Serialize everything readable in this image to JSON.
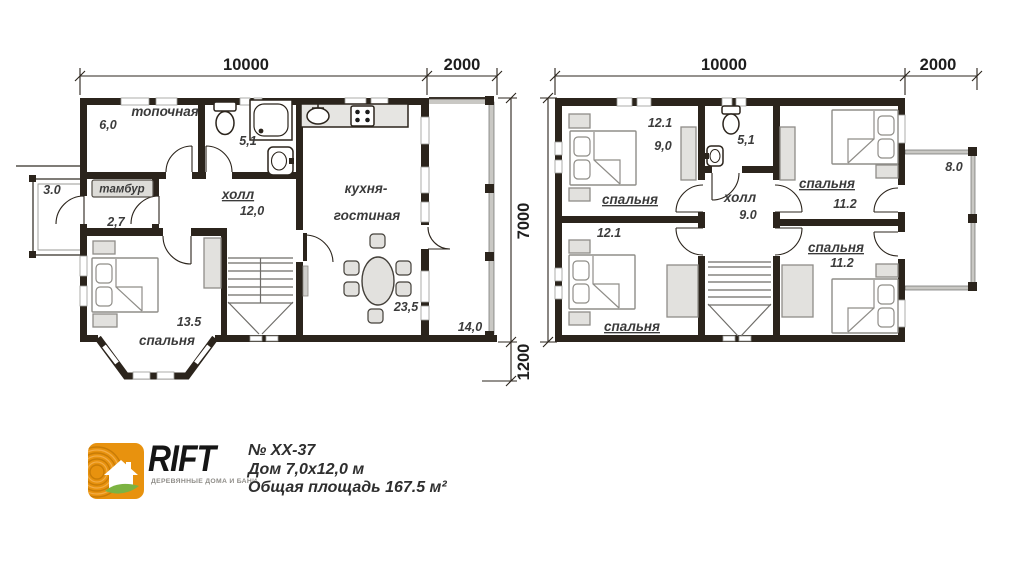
{
  "colors": {
    "wall": "#2b241c",
    "furniture": "#e2e1de",
    "logo_orange": "#e8920e",
    "logo_green": "#7cb342",
    "text": "#3b3b3b"
  },
  "floor1": {
    "dims": {
      "top_main": "10000",
      "top_terrace": "2000",
      "right_total": "7000",
      "right_bay": "1200"
    },
    "rooms": {
      "boiler": {
        "name": "топочная",
        "area": "6,0"
      },
      "porch": {
        "area": "3.0"
      },
      "vestibule": {
        "name": "тамбур",
        "area": "2,7"
      },
      "bathroom": {
        "area": "5,1"
      },
      "hall": {
        "name": "холл",
        "area": "12,0"
      },
      "kitchen_living": {
        "name_line1": "кухня-",
        "name_line2": "гостиная",
        "area": "23,5"
      },
      "bedroom": {
        "name": "спальня",
        "area": "13.5"
      },
      "terrace": {
        "area": "14,0"
      }
    }
  },
  "floor2": {
    "dims": {
      "top_main": "10000",
      "top_balcony": "2000"
    },
    "rooms": {
      "bedroom_top_left": {
        "name": "спальня",
        "area": "12.1",
        "area_extra": "9,0"
      },
      "bathroom": {
        "area": "5,1"
      },
      "bedroom_top_right": {
        "name": "спальня",
        "area": "11.2"
      },
      "hall": {
        "name": "холл",
        "area": "9.0"
      },
      "bedroom_bottom_left": {
        "name": "спальня",
        "area": "12.1"
      },
      "bedroom_bottom_right": {
        "name": "спальня",
        "area": "11.2"
      },
      "balcony": {
        "area": "8.0"
      }
    }
  },
  "footer": {
    "brand": "RIFT",
    "tagline": "ДЕРЕВЯННЫЕ ДОМА И БАНИ",
    "project_no": "№ ХХ-37",
    "house_size": "Дом 7,0х12,0 м",
    "total_area": "Общая площадь 167.5 м²",
    "logo_icon": "house-with-leaf"
  }
}
